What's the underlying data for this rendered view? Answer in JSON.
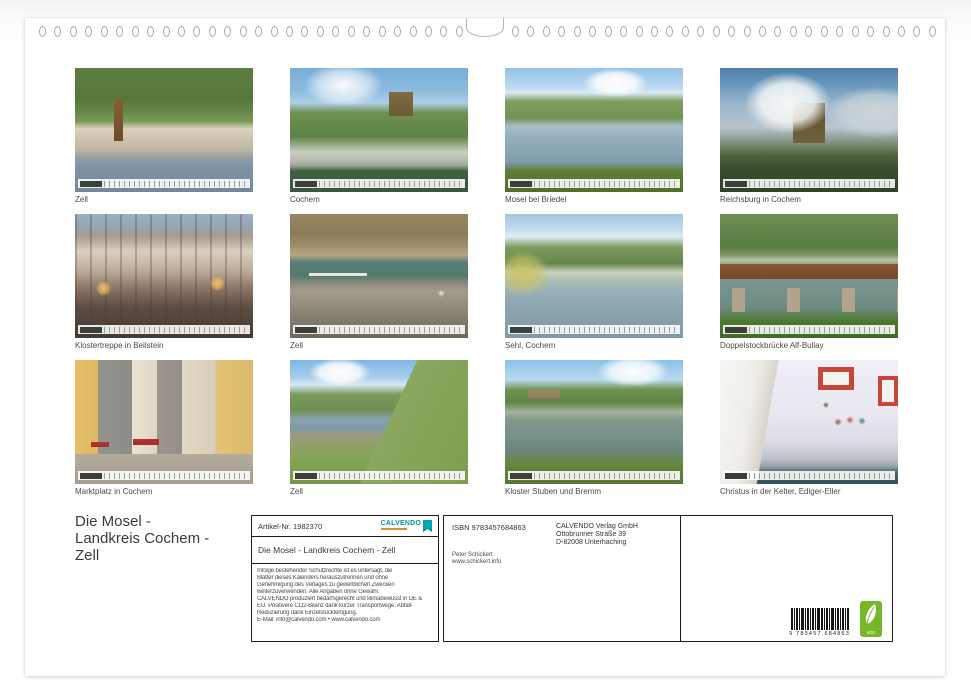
{
  "page": {
    "binding": {
      "left_holes": 28,
      "right_holes": 28
    },
    "title_lines": [
      "Die Mosel -",
      "Landkreis Cochem -",
      "Zell"
    ]
  },
  "thumbnails": [
    {
      "caption": "Zell"
    },
    {
      "caption": "Cochem"
    },
    {
      "caption": "Mosel bei Briedel"
    },
    {
      "caption": "Reichsburg in Cochem"
    },
    {
      "caption": "Klostertreppe in Beilstein"
    },
    {
      "caption": "Zell"
    },
    {
      "caption": "Sehl, Cochem"
    },
    {
      "caption": "Doppelstockbrücke Alf-Bullay"
    },
    {
      "caption": "Marktplatz in Cochem"
    },
    {
      "caption": "Zell"
    },
    {
      "caption": "Kloster Stuben und Bremm"
    },
    {
      "caption": "Christus in der Kelter, Ediger-Eller"
    }
  ],
  "info_box": {
    "article_no": "Artikel-Nr. 1982370",
    "brand": "CALVENDO",
    "calendar_title": "Die Mosel - Landkreis Cochem - Zell",
    "legal_lines": [
      "Infolge bestehender Schutzrechte ist es untersagt, die",
      "Blätter dieses Kalenders herauszutrennen und ohne",
      "Genehmigung des Verlages zu gewerblichen Zwecken",
      "weiterzuverwenden. Alle Angaben ohne Gewähr.",
      "CALVENDO produziert bedarfsgerecht und klimabewusst in DE &",
      "EU. Positivere CO2-Bilanz dank kurzer Transportwege. Abfall-",
      "Reduzierung dank Einzelstückfertigung.",
      "E-Mail: info@calvendo.com • www.calvendo.com"
    ],
    "isbn": "ISBN 9783457684863",
    "publisher_lines": [
      "CALVENDO Verlag GmbH",
      "Ottobrunner Straße 39",
      "D-82008 Unterhaching"
    ],
    "author_lines": [
      "Peter Schickert",
      "www.schickert.info"
    ],
    "barcode_number": "9 783457 684863",
    "eco_label": "eco"
  },
  "colors": {
    "brand_teal": "#0099a8",
    "eco_green": "#76b82a"
  }
}
